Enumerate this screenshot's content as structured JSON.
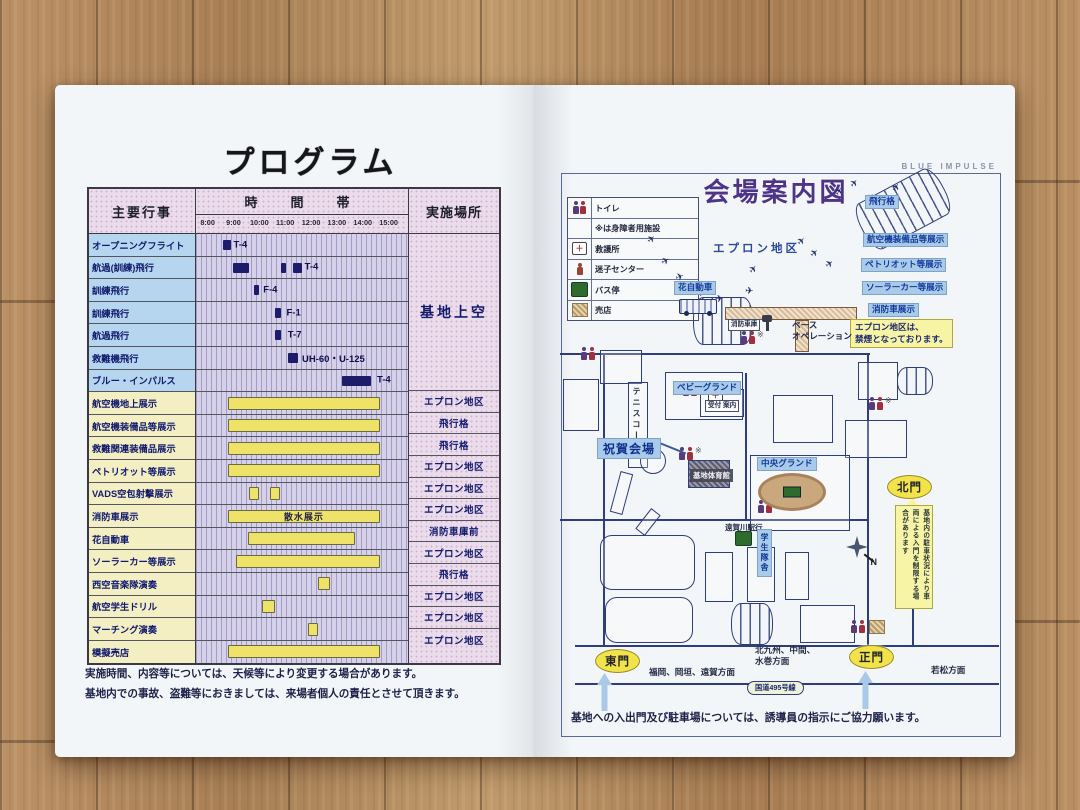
{
  "left_page": {
    "title": "プログラム",
    "table": {
      "header": {
        "events": "主要行事",
        "time_band": "時　間　帯",
        "location": "実施場所"
      },
      "time_ticks": [
        "8:00",
        "9:00",
        "10:00",
        "11:00",
        "12:00",
        "13:00",
        "14:00",
        "15:00"
      ],
      "axis": {
        "start": 7.55,
        "end": 15.75
      },
      "rows": [
        {
          "label": "オープニングフライト",
          "type": "flight",
          "bars": [
            {
              "s": 8.6,
              "e": 8.9,
              "c": "navy"
            }
          ],
          "note": "T-4",
          "note_at": 9.0,
          "location": "基地上空",
          "loc_span": 7
        },
        {
          "label": "航過(訓練)飛行",
          "type": "flight",
          "bars": [
            {
              "s": 9.0,
              "e": 9.6,
              "c": "navy"
            },
            {
              "s": 10.85,
              "e": 11.05,
              "c": "navy"
            },
            {
              "s": 11.3,
              "e": 11.65,
              "c": "navy"
            }
          ],
          "note": "T-4",
          "note_at": 11.75
        },
        {
          "label": "訓練飛行",
          "type": "flight",
          "bars": [
            {
              "s": 9.8,
              "e": 10.0,
              "c": "navy"
            }
          ],
          "note": "F-4",
          "note_at": 10.15
        },
        {
          "label": "訓練飛行",
          "type": "flight",
          "bars": [
            {
              "s": 10.6,
              "e": 10.85,
              "c": "navy"
            }
          ],
          "note": "F-1",
          "note_at": 11.05
        },
        {
          "label": "航過飛行",
          "type": "flight",
          "bars": [
            {
              "s": 10.6,
              "e": 10.85,
              "c": "navy"
            }
          ],
          "note": "T-7",
          "note_at": 11.1
        },
        {
          "label": "救難機飛行",
          "type": "flight",
          "bars": [
            {
              "s": 11.1,
              "e": 11.5,
              "c": "navy"
            }
          ],
          "note": "UH-60・U-125",
          "note_at": 11.65
        },
        {
          "label": "ブルー・インパルス",
          "type": "flight",
          "bars": [
            {
              "s": 13.2,
              "e": 14.3,
              "c": "navy"
            }
          ],
          "note": "T-4",
          "note_at": 14.55
        },
        {
          "label": "航空機地上展示",
          "type": "ground",
          "bars": [
            {
              "s": 8.8,
              "e": 14.65,
              "c": "yellow"
            }
          ],
          "location": "エプロン地区"
        },
        {
          "label": "航空機装備品等展示",
          "type": "ground",
          "bars": [
            {
              "s": 8.8,
              "e": 14.65,
              "c": "yellow"
            }
          ],
          "location": "飛行格"
        },
        {
          "label": "救難関連装備品展示",
          "type": "ground",
          "bars": [
            {
              "s": 8.8,
              "e": 14.65,
              "c": "yellow"
            }
          ],
          "location": "飛行格"
        },
        {
          "label": "ペトリオット等展示",
          "type": "ground",
          "bars": [
            {
              "s": 8.8,
              "e": 14.65,
              "c": "yellow"
            }
          ],
          "location": "エプロン地区"
        },
        {
          "label": "VADS空包射撃展示",
          "type": "ground",
          "bars": [
            {
              "s": 9.6,
              "e": 10.0,
              "c": "yellow"
            },
            {
              "s": 10.4,
              "e": 10.8,
              "c": "yellow"
            }
          ],
          "location": "エプロン地区"
        },
        {
          "label": "消防車展示",
          "type": "ground",
          "bars": [
            {
              "s": 8.8,
              "e": 14.65,
              "c": "yellow",
              "text": "散水展示"
            }
          ],
          "location": "エプロン地区"
        },
        {
          "label": "花自動車",
          "type": "ground",
          "bars": [
            {
              "s": 9.55,
              "e": 13.7,
              "c": "yellow"
            }
          ],
          "location": "消防車庫前"
        },
        {
          "label": "ソーラーカー等展示",
          "type": "ground",
          "bars": [
            {
              "s": 9.1,
              "e": 14.65,
              "c": "yellow"
            }
          ],
          "location": "エプロン地区"
        },
        {
          "label": "西空音楽隊演奏",
          "type": "ground",
          "bars": [
            {
              "s": 12.25,
              "e": 12.75,
              "c": "yellow"
            }
          ],
          "location": "飛行格"
        },
        {
          "label": "航空学生ドリル",
          "type": "ground",
          "bars": [
            {
              "s": 10.1,
              "e": 10.6,
              "c": "yellow"
            }
          ],
          "location": "エプロン地区"
        },
        {
          "label": "マーチング演奏",
          "type": "ground",
          "bars": [
            {
              "s": 11.9,
              "e": 12.25,
              "c": "yellow"
            }
          ],
          "location": "エプロン地区"
        },
        {
          "label": "模擬売店",
          "type": "ground",
          "bars": [
            {
              "s": 8.8,
              "e": 14.65,
              "c": "yellow"
            }
          ],
          "location": "エプロン地区"
        }
      ]
    },
    "notes": "実施時間、内容等については、天候等により変更する場合があります。\n基地内での事故、盗難等におきましては、来場者個人の責任とさせて頂きます。"
  },
  "right_page": {
    "title": "会場案内図",
    "watermark": "BLUE IMPULSE",
    "legend": [
      {
        "icon": "toilet",
        "label": "トイレ"
      },
      {
        "icon": "none",
        "label": "※は身障者用施設"
      },
      {
        "icon": "aid",
        "label": "救護所"
      },
      {
        "icon": "lost-child",
        "label": "迷子センター"
      },
      {
        "icon": "bus",
        "label": "バス停"
      },
      {
        "icon": "shop",
        "label": "売店"
      }
    ],
    "bottom_note": "基地への入出門及び駐車場については、誘導員の指示にご協力願います。",
    "labels": [
      {
        "text": "エプロン地区",
        "x": 168,
        "y": 83,
        "style": "area"
      },
      {
        "text": "飛行格",
        "x": 320,
        "y": 38,
        "style": "blue"
      },
      {
        "text": "航空機装備品等展示",
        "x": 318,
        "y": 76,
        "style": "blue"
      },
      {
        "text": "ペトリオット等展示",
        "x": 316,
        "y": 101,
        "style": "blue"
      },
      {
        "text": "ソーラーカー等展示",
        "x": 317,
        "y": 124,
        "style": "blue"
      },
      {
        "text": "消防車展示",
        "x": 323,
        "y": 146,
        "style": "blue"
      },
      {
        "text": "エプロン地区は、\n禁煙となっております。",
        "x": 305,
        "y": 162,
        "style": "ynote"
      },
      {
        "text": "花自動車",
        "x": 129,
        "y": 124,
        "style": "blue"
      },
      {
        "text": "消防車庫",
        "x": 183,
        "y": 162,
        "style": "minibox"
      },
      {
        "text": "ベース\nオペレーション",
        "x": 247,
        "y": 163,
        "style": "plain"
      },
      {
        "text": "受付 案内",
        "x": 160,
        "y": 243,
        "style": "minibox"
      },
      {
        "text": "ベビーグランド",
        "x": 128,
        "y": 224,
        "style": "blue"
      },
      {
        "text": "テニスコート",
        "x": 86,
        "y": 230,
        "style": "vplain"
      },
      {
        "text": "祝賀会場",
        "x": 52,
        "y": 281,
        "style": "blue-big"
      },
      {
        "text": "基地体育館",
        "x": 145,
        "y": 312,
        "style": "dark"
      },
      {
        "text": "中央グランド",
        "x": 212,
        "y": 300,
        "style": "blue"
      },
      {
        "text": "遠賀川駅行",
        "x": 180,
        "y": 366,
        "style": "small"
      },
      {
        "text": "学生隊舎",
        "x": 212,
        "y": 372,
        "style": "vblue"
      },
      {
        "text": "東門",
        "x": 50,
        "y": 492,
        "style": "gate"
      },
      {
        "text": "福岡、岡垣、遠賀方面",
        "x": 104,
        "y": 510,
        "style": "plain"
      },
      {
        "text": "北九州、中間、\n水巻方面",
        "x": 210,
        "y": 488,
        "style": "plain"
      },
      {
        "text": "正門",
        "x": 304,
        "y": 488,
        "style": "gate"
      },
      {
        "text": "北門",
        "x": 342,
        "y": 318,
        "style": "gate"
      },
      {
        "text": "基地内の駐車状況により車両による入門を制限する場合があります",
        "x": 350,
        "y": 348,
        "style": "vnote",
        "h": 96
      },
      {
        "text": "若松方面",
        "x": 386,
        "y": 508,
        "style": "plain"
      },
      {
        "text": "国道495号線",
        "x": 202,
        "y": 524,
        "style": "pill"
      }
    ],
    "map": {
      "roads": [
        {
          "x": 15,
          "y": 196,
          "w": 310,
          "h": 2
        },
        {
          "x": 58,
          "y": 198,
          "w": 2,
          "h": 292
        },
        {
          "x": 322,
          "y": 198,
          "w": 2,
          "h": 292
        },
        {
          "x": 367,
          "y": 340,
          "w": 2,
          "h": 150
        },
        {
          "x": 30,
          "y": 488,
          "w": 424,
          "h": 2
        },
        {
          "x": 30,
          "y": 526,
          "w": 424,
          "h": 2
        },
        {
          "x": 15,
          "y": 362,
          "w": 308,
          "h": 2
        },
        {
          "x": 200,
          "y": 216,
          "w": 2,
          "h": 146
        }
      ],
      "buildings": [
        {
          "x": 55,
          "y": 193,
          "w": 42,
          "h": 34,
          "style": "plain"
        },
        {
          "x": 18,
          "y": 222,
          "w": 36,
          "h": 52,
          "style": "plain"
        },
        {
          "x": 83,
          "y": 225,
          "w": 20,
          "h": 86,
          "style": "plain"
        },
        {
          "x": 120,
          "y": 215,
          "w": 78,
          "h": 48,
          "style": "plain"
        },
        {
          "x": 95,
          "y": 291,
          "w": 26,
          "h": 26,
          "style": "circle"
        },
        {
          "x": 70,
          "y": 315,
          "w": 13,
          "h": 42,
          "style": "plain",
          "rot": 15
        },
        {
          "x": 97,
          "y": 352,
          "w": 12,
          "h": 26,
          "style": "plain",
          "rot": 38
        },
        {
          "x": 155,
          "y": 232,
          "w": 44,
          "h": 28,
          "style": "plain"
        },
        {
          "x": 228,
          "y": 238,
          "w": 60,
          "h": 48,
          "style": "plain"
        },
        {
          "x": 300,
          "y": 263,
          "w": 62,
          "h": 38,
          "style": "plain"
        },
        {
          "x": 313,
          "y": 205,
          "w": 40,
          "h": 38,
          "style": "plain"
        },
        {
          "x": 205,
          "y": 298,
          "w": 100,
          "h": 76,
          "style": "plain"
        },
        {
          "x": 55,
          "y": 378,
          "w": 95,
          "h": 55,
          "style": "blob"
        },
        {
          "x": 60,
          "y": 440,
          "w": 88,
          "h": 46,
          "style": "blob"
        },
        {
          "x": 160,
          "y": 395,
          "w": 28,
          "h": 50,
          "style": "plain"
        },
        {
          "x": 202,
          "y": 390,
          "w": 28,
          "h": 55,
          "style": "plain"
        },
        {
          "x": 240,
          "y": 395,
          "w": 24,
          "h": 48,
          "style": "plain"
        },
        {
          "x": 255,
          "y": 448,
          "w": 55,
          "h": 38,
          "style": "plain"
        },
        {
          "x": 143,
          "y": 303,
          "w": 42,
          "h": 28,
          "style": "dark"
        }
      ],
      "quonsets": [
        {
          "x": 148,
          "y": 140,
          "w": 60,
          "h": 48,
          "rot": 0
        },
        {
          "x": 312,
          "y": 26,
          "w": 92,
          "h": 52,
          "rot": -28
        },
        {
          "x": 352,
          "y": 210,
          "w": 36,
          "h": 28,
          "rot": 0
        },
        {
          "x": 186,
          "y": 446,
          "w": 42,
          "h": 42,
          "rot": 0
        }
      ],
      "hatches": [
        {
          "x": 180,
          "y": 150,
          "w": 132,
          "h": 13
        },
        {
          "x": 250,
          "y": 163,
          "w": 14,
          "h": 32
        }
      ],
      "planes": [
        {
          "x": 103,
          "y": 78,
          "r": -40
        },
        {
          "x": 117,
          "y": 100,
          "r": -30
        },
        {
          "x": 131,
          "y": 116,
          "r": -20
        },
        {
          "x": 152,
          "y": 132,
          "r": -12
        },
        {
          "x": 170,
          "y": 138,
          "r": -5
        },
        {
          "x": 200,
          "y": 130,
          "r": 0
        },
        {
          "x": 205,
          "y": 108,
          "r": -50
        },
        {
          "x": 253,
          "y": 80,
          "r": -45
        },
        {
          "x": 266,
          "y": 92,
          "r": -40
        },
        {
          "x": 281,
          "y": 103,
          "r": -35
        },
        {
          "x": 291,
          "y": 30,
          "r": -60
        },
        {
          "x": 306,
          "y": 22,
          "r": -50
        },
        {
          "x": 322,
          "y": 36,
          "r": -45
        },
        {
          "x": 348,
          "y": 26,
          "r": -55
        }
      ],
      "toilets": [
        {
          "x": 36,
          "y": 190,
          "star": false
        },
        {
          "x": 138,
          "y": 226,
          "star": true
        },
        {
          "x": 196,
          "y": 174,
          "star": true
        },
        {
          "x": 134,
          "y": 290,
          "star": true
        },
        {
          "x": 213,
          "y": 343,
          "star": false
        },
        {
          "x": 324,
          "y": 240,
          "star": true
        },
        {
          "x": 306,
          "y": 463,
          "star": false
        }
      ],
      "shops": [
        {
          "x": 324,
          "y": 463
        }
      ],
      "bus_stops": [
        {
          "x": 190,
          "y": 374
        }
      ],
      "aids": [
        {
          "x": 163,
          "y": 232
        }
      ],
      "trucks": [
        {
          "x": 134,
          "y": 142
        }
      ],
      "towers": [
        {
          "x": 216,
          "y": 158
        }
      ],
      "ovals": [
        {
          "x": 213,
          "y": 316,
          "w": 62,
          "h": 32
        }
      ],
      "arrows": [
        {
          "x": 52,
          "y": 516
        },
        {
          "x": 313,
          "y": 514
        }
      ],
      "compass": {
        "x": 298,
        "y": 376,
        "n": "N"
      },
      "callout_tail": {
        "x": 362,
        "y": 339
      },
      "arrow_lines": [
        {
          "x": 112,
          "y": 290,
          "w": 30,
          "r": 22
        }
      ]
    }
  }
}
